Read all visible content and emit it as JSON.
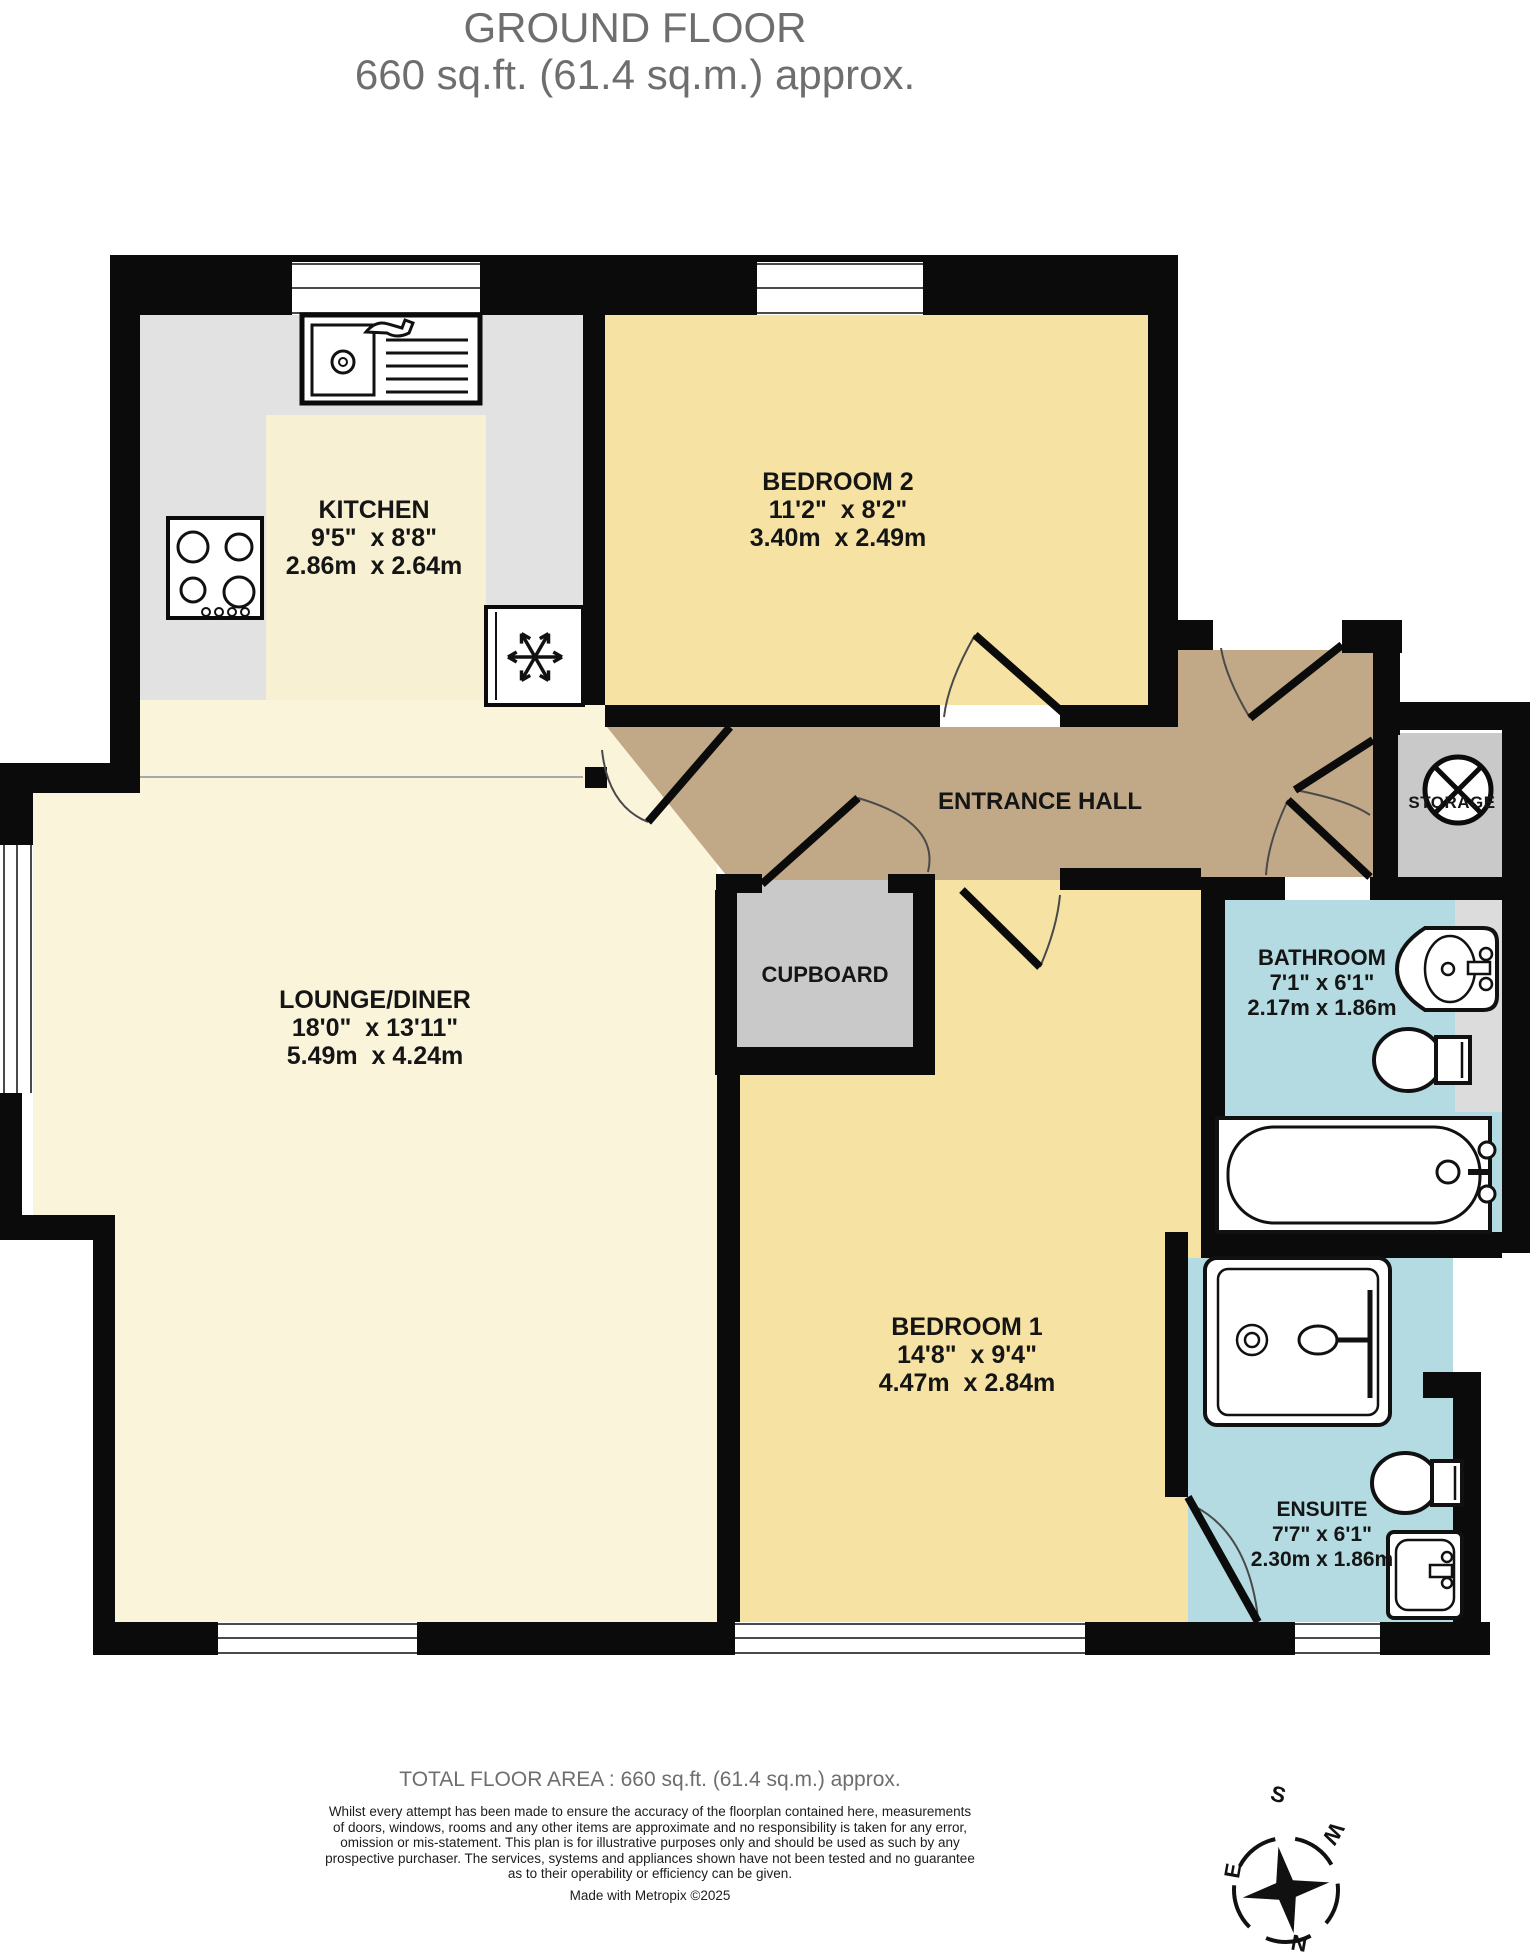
{
  "title": {
    "line1": "GROUND FLOOR",
    "line2": "660 sq.ft. (61.4 sq.m.) approx."
  },
  "rooms": {
    "kitchen": {
      "name": "KITCHEN",
      "imperial": "9'5\"  x 8'8\"",
      "metric": "2.86m  x 2.64m"
    },
    "bedroom2": {
      "name": "BEDROOM 2",
      "imperial": "11'2\"  x 8'2\"",
      "metric": "3.40m  x 2.49m"
    },
    "lounge": {
      "name": "LOUNGE/DINER",
      "imperial": "18'0\"  x 13'11\"",
      "metric": "5.49m  x 4.24m"
    },
    "bedroom1": {
      "name": "BEDROOM 1",
      "imperial": "14'8\"  x 9'4\"",
      "metric": "4.47m  x 2.84m"
    },
    "bathroom": {
      "name": "BATHROOM",
      "imperial": "7'1\"  x 6'1\"",
      "metric": "2.17m  x 1.86m"
    },
    "ensuite": {
      "name": "ENSUITE",
      "imperial": "7'7\"  x 6'1\"",
      "metric": "2.30m  x 1.86m"
    }
  },
  "labels": {
    "entrance_hall": "ENTRANCE HALL",
    "cupboard": "CUPBOARD",
    "storage": "STORAGE"
  },
  "compass": {
    "north": "N",
    "east": "E",
    "south": "S",
    "west": "W"
  },
  "footer": {
    "total_area": "TOTAL FLOOR AREA : 660 sq.ft. (61.4 sq.m.) approx.",
    "disclaimer_lines": [
      "Whilst every attempt has been made to ensure the accuracy of the floorplan contained here, measurements",
      "of doors, windows, rooms and any other items are approximate and no responsibility is taken for any error,",
      "omission or mis-statement. This plan is for illustrative purposes only and should be used as such by any",
      "prospective purchaser. The services, systems and appliances shown have not been tested and no guarantee",
      "as to their operability or efficiency can be given."
    ],
    "credit": "Made with Metropix ©2025"
  },
  "colors": {
    "wall": "#0b0b0b",
    "bedroom_fill": "#f6e3a4",
    "lounge_fill": "#faf5da",
    "hall_fill": "#c1a886",
    "bath_fill": "#b3dbe1",
    "utility_gray": "#c9c9c9",
    "counter_gray": "#e2e2e2",
    "title_gray": "#6e6e6e"
  }
}
